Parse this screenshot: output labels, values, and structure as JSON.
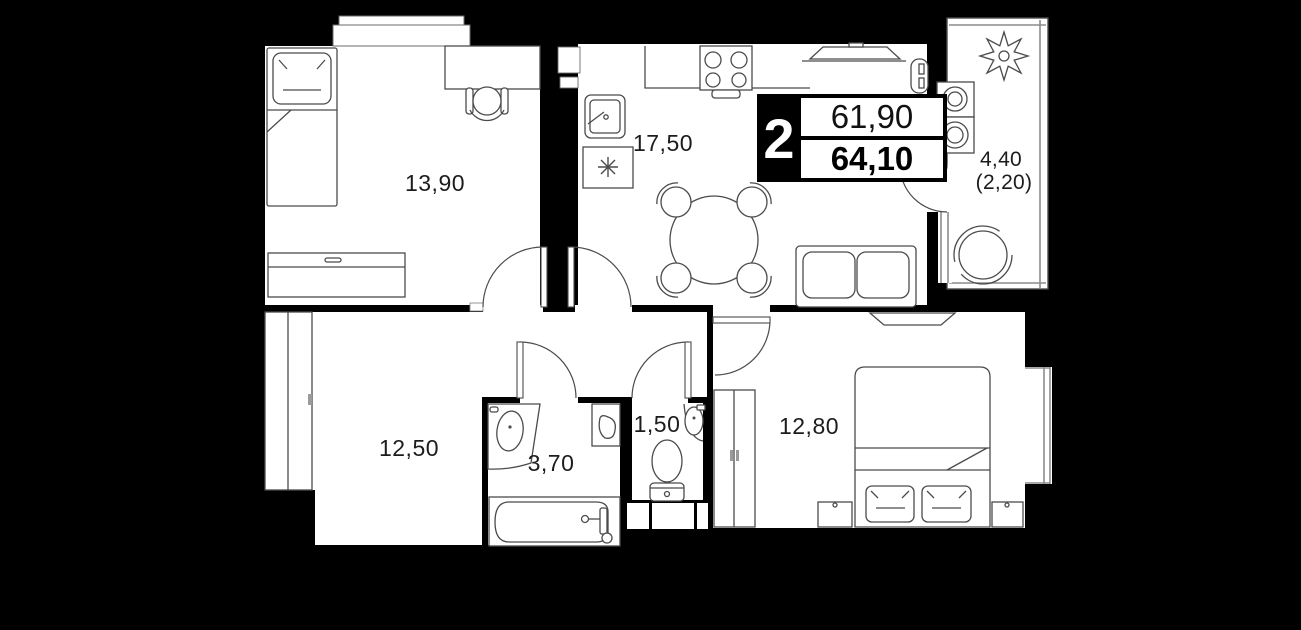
{
  "plan": {
    "title": "2-room apartment floor plan",
    "badge": {
      "rooms_count": "2",
      "living_area": "61,90",
      "total_area": "64,10"
    },
    "rooms": {
      "bedroom1": {
        "area": "13,90"
      },
      "kitchen_living": {
        "area": "17,50"
      },
      "hall": {
        "area": "12,50"
      },
      "bathroom": {
        "area": "3,70"
      },
      "wc": {
        "area": "1,50"
      },
      "bedroom2": {
        "area": "12,80"
      },
      "balcony": {
        "area": "4,40",
        "area_coefficient": "(2,20)"
      }
    },
    "colors": {
      "background": "#000000",
      "walls": "#000000",
      "floor": "#ffffff",
      "furniture_line": "#4b4b4b",
      "glazing_line": "#8c8c8c",
      "badge_background": "#000000",
      "badge_text": "#ffffff"
    }
  }
}
